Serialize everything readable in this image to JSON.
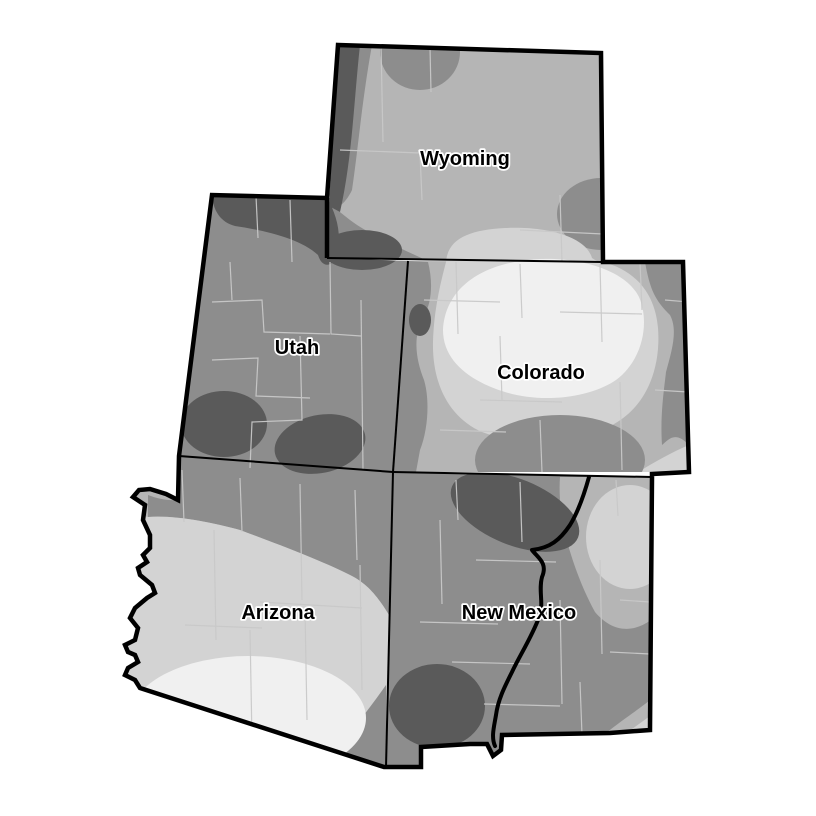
{
  "map": {
    "background": "#ffffff",
    "states": [
      {
        "name": "Wyoming"
      },
      {
        "name": "Utah"
      },
      {
        "name": "Colorado"
      },
      {
        "name": "Arizona"
      },
      {
        "name": "New Mexico"
      }
    ],
    "shading": {
      "levels": [
        {
          "name": "lightest",
          "color": "#f0f0f0"
        },
        {
          "name": "light",
          "color": "#d3d3d3"
        },
        {
          "name": "medium",
          "color": "#b5b5b5"
        },
        {
          "name": "dark",
          "color": "#8d8d8d"
        },
        {
          "name": "darkest",
          "color": "#5a5a5a"
        }
      ],
      "county_line_color": "#c9c9c9",
      "border_color": "#000000",
      "river_color": "#000000",
      "label_color": "#000000",
      "label_halo_color": "#ffffff"
    }
  }
}
